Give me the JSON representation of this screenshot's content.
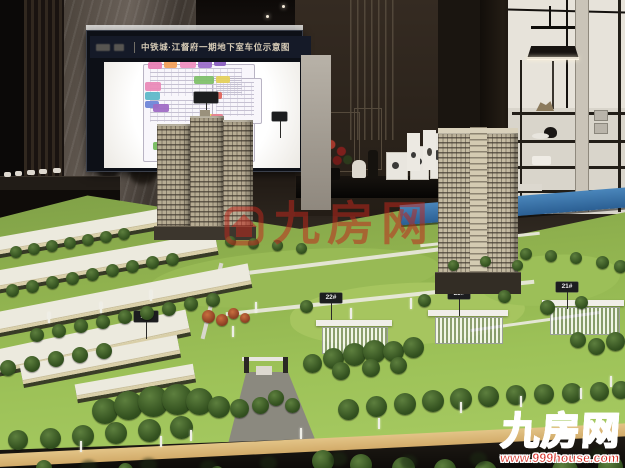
{
  "board": {
    "title": "中铁城·江督府一期地下室车位示意图"
  },
  "model": {
    "building_signs": {
      "b25": "25#",
      "b22": "22#",
      "b23": "23#",
      "b21": "21#"
    }
  },
  "watermarks": {
    "center": {
      "brand": "九房网"
    },
    "corner": {
      "brand": "九房网",
      "url": "www.999house.com"
    }
  },
  "colors": {
    "watermark_red": "#d3251a",
    "lawn_green": "#9abf55",
    "table_edge_blue": "#2f6fa8",
    "tower_beige": "#c0b59c",
    "board_navy": "#151a28"
  }
}
